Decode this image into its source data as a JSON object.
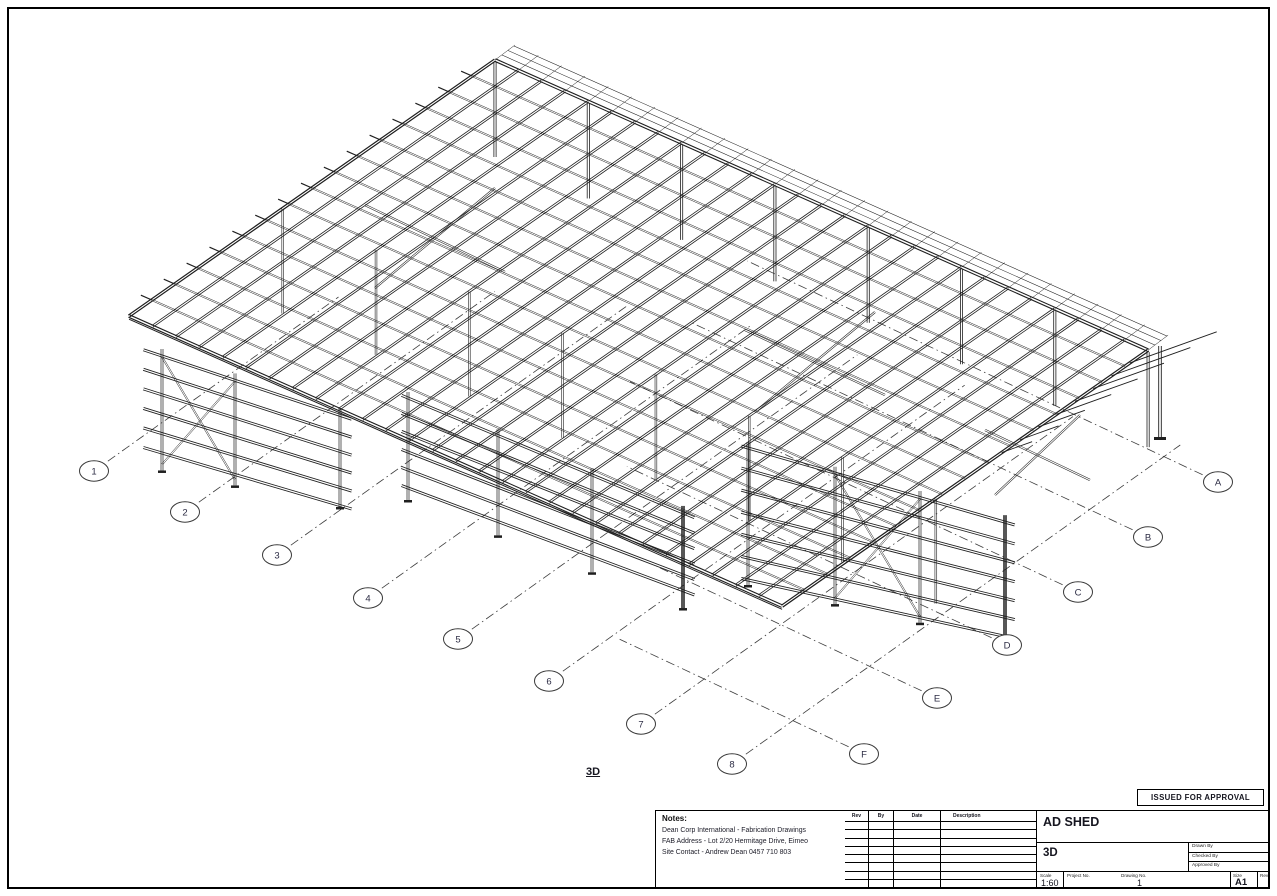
{
  "sheet": {
    "view_label": "3D"
  },
  "stamp": {
    "text": "ISSUED FOR APPROVAL"
  },
  "grids": {
    "numbered": [
      "1",
      "2",
      "3",
      "4",
      "5",
      "6",
      "7",
      "8"
    ],
    "lettered": [
      "A",
      "B",
      "C",
      "D",
      "E",
      "F"
    ]
  },
  "notes": {
    "heading": "Notes:",
    "lines": [
      "Dean Corp International - Fabrication Drawings",
      "FAB Address - Lot 2/20 Hermitage Drive, Eimeo",
      "Site Contact - Andrew Dean 0457 710 803"
    ]
  },
  "revision_table": {
    "headers": [
      "Rev",
      "By",
      "Date",
      "Description"
    ],
    "empty_rows": 8
  },
  "title_block": {
    "project_title": "AD SHED",
    "view_name": "3D",
    "drawn_by_label": "Drawn By",
    "checked_by_label": "Checked By",
    "approved_by_label": "Approved By",
    "scale_label": "Scale",
    "scale_value": "1:60",
    "project_no_label": "Project No.",
    "drawing_no_label": "Drawing No.",
    "drawing_no_value": "1",
    "size_label": "Size",
    "size_value": "A1",
    "rev_label": "Rev"
  },
  "colors": {
    "line": "#1f1f1f",
    "grid_dash": "#3c3c3c",
    "bubble_text": "#2c2c44"
  }
}
